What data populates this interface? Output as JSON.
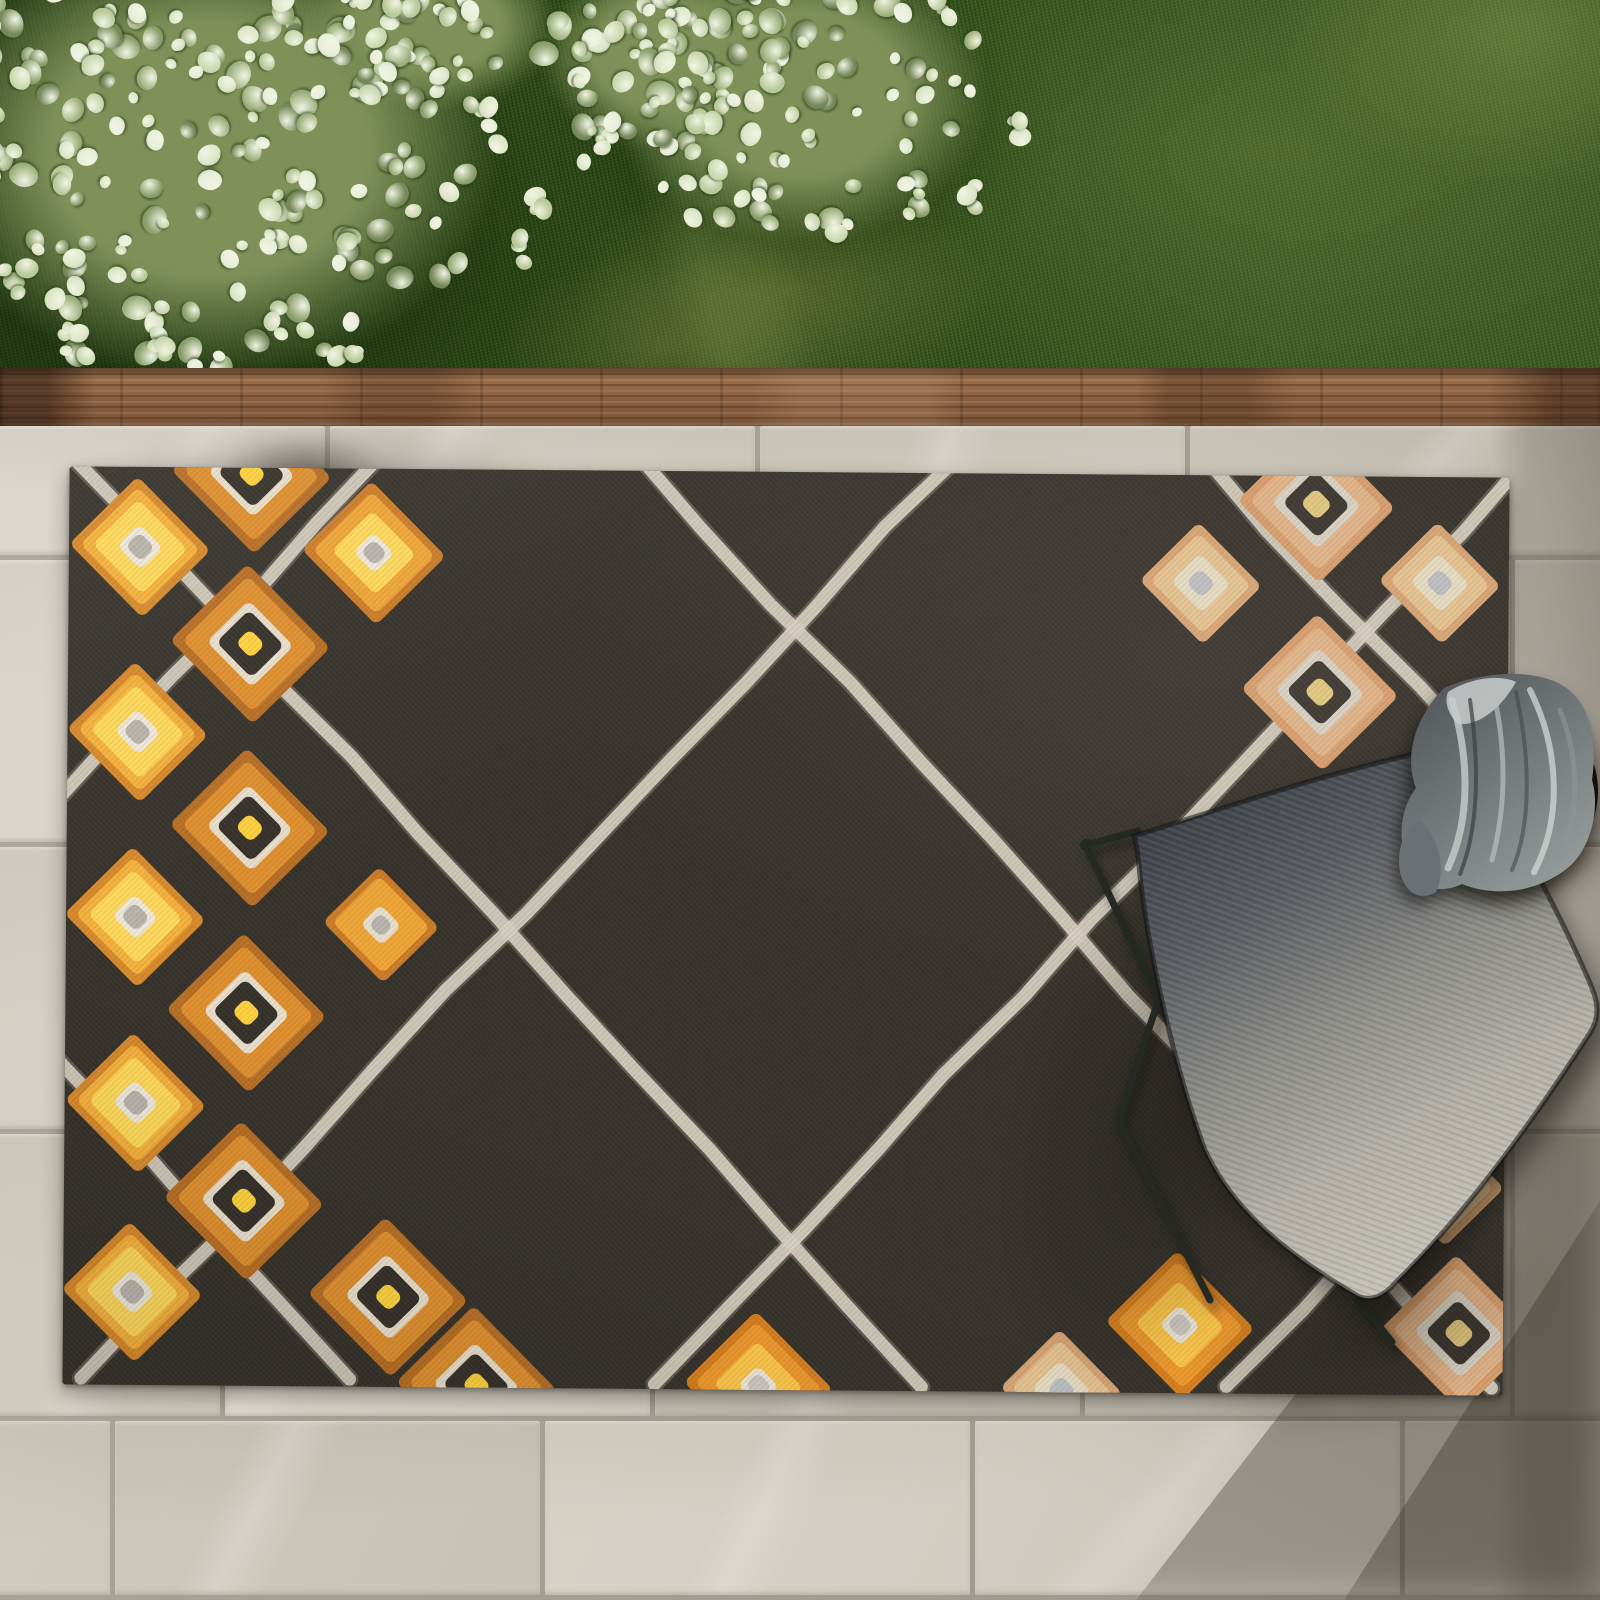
{
  "meta": {
    "description": "Top-down outdoor scene: charcoal Moroccan-trellis area rug with cream lattice and orange diamond motifs on a stone tile patio; grass lawn and variegated shrub above a wood edging board; gray ombre sling chair, round wicker side table with gray towel; soft shadows lower right"
  },
  "scene": {
    "canvas": {
      "width": 1600,
      "height": 1600
    },
    "grass": {
      "base": "#33501d"
    },
    "bush": {
      "light": [
        "#e9eedb",
        "#dde6c8",
        "#ccd9b1",
        "#b9c99b"
      ],
      "dark": [
        "#a2b483",
        "#8da06f",
        "#76885b"
      ],
      "clumps": [
        [
          210,
          150,
          290,
          230,
          205
        ],
        [
          660,
          55,
          120,
          95,
          62
        ],
        [
          800,
          95,
          190,
          150,
          92
        ],
        [
          430,
          25,
          130,
          85,
          46
        ]
      ],
      "strays": [
        [
          545,
          205
        ],
        [
          520,
          250
        ],
        [
          80,
          345
        ],
        [
          150,
          360
        ],
        [
          960,
          200
        ],
        [
          1005,
          135
        ],
        [
          350,
          365
        ],
        [
          600,
          150
        ]
      ]
    },
    "wood_edge": {
      "color": "#8a5f41"
    },
    "patio": {
      "tile_w": 430,
      "gap": 5,
      "grout": "#a7a196",
      "palette": [
        "#d8d3c8",
        "#d3cec3",
        "#cdc8bc",
        "#dcd7cc",
        "#d0cabe",
        "#d6d0c5"
      ],
      "rows": [
        [
          426,
          134,
          -100
        ],
        [
          560,
          287,
          -205
        ],
        [
          847,
          287,
          -100
        ],
        [
          1134,
          287,
          -205
        ],
        [
          1421,
          179,
          -315
        ]
      ]
    },
    "rug": {
      "x": 66,
      "y": 472,
      "w": 1440,
      "h": 918,
      "rot": 0.45,
      "bg": "#36322b",
      "line": {
        "color": "#d7d0c1",
        "width": 13,
        "slope": 1.08,
        "wobble": 11,
        "a_starts": [
          -557,
          13,
          583,
          1153,
          1723
        ],
        "b_starts": [
          298,
          868,
          1438,
          2008
        ]
      },
      "motif_types": {
        "yellow": [
          [
            "#d98a2b",
            104
          ],
          [
            "#f6b23c",
            88
          ],
          [
            "#ffd95c",
            70
          ],
          [
            "#efe8da",
            34
          ],
          [
            "#b9b4ac",
            22
          ]
        ],
        "orangeRing": [
          [
            "#b96f24",
            118
          ],
          [
            "#e0902e",
            100
          ],
          [
            "#e9dfcc",
            64
          ],
          [
            "#35312a",
            50
          ],
          [
            "#ffd23e",
            22
          ]
        ],
        "orangeYellowGray": [
          [
            "#cd7d28",
            106
          ],
          [
            "#f0a636",
            90
          ],
          [
            "#ffd95c",
            62
          ],
          [
            "#efe8da",
            30
          ],
          [
            "#b9b4ac",
            20
          ]
        ],
        "orangeSmallGray": [
          [
            "#cd7d28",
            86
          ],
          [
            "#f0a636",
            72
          ],
          [
            "#e8dfce",
            30
          ],
          [
            "#b9b4ac",
            18
          ]
        ],
        "peachRing": [
          [
            "#d99e6c",
            116
          ],
          [
            "#e2b488",
            98
          ],
          [
            "#d9d2c4",
            66
          ],
          [
            "#3a352e",
            50
          ],
          [
            "#e2c87e",
            24
          ]
        ],
        "peachSmall": [
          [
            "#d9a573",
            90
          ],
          [
            "#e6c391",
            74
          ],
          [
            "#e6dcc2",
            44
          ],
          [
            "#bcbfc2",
            22
          ]
        ],
        "orangeBright": [
          [
            "#d9811f",
            110
          ],
          [
            "#f09a2e",
            94
          ],
          [
            "#ffc84a",
            66
          ],
          [
            "#efe8da",
            30
          ],
          [
            "#cfcac2",
            20
          ]
        ]
      },
      "motifs": [
        [
          137,
          552,
          "yellow"
        ],
        [
          248,
          478,
          "orangeRing"
        ],
        [
          371,
          556,
          "orangeYellowGray"
        ],
        [
          248,
          648,
          "orangeRing"
        ],
        [
          136,
          737,
          "yellow"
        ],
        [
          249,
          832,
          "orangeRing"
        ],
        [
          135,
          922,
          "yellow"
        ],
        [
          381,
          928,
          "orangeSmallGray"
        ],
        [
          247,
          1017,
          "orangeRing"
        ],
        [
          137,
          1108,
          "yellow"
        ],
        [
          246,
          1205,
          "orangeRing"
        ],
        [
          135,
          1297,
          "yellow"
        ],
        [
          391,
          1300,
          "orangeRing"
        ],
        [
          480,
          1388,
          "orangeRing"
        ],
        [
          762,
          1386,
          "orangeBright"
        ],
        [
          1313,
          500,
          "peachRing"
        ],
        [
          1198,
          580,
          "peachSmall"
        ],
        [
          1437,
          578,
          "peachSmall"
        ],
        [
          1318,
          688,
          "peachRing"
        ],
        [
          1445,
          1180,
          "peachSmall"
        ],
        [
          1462,
          1328,
          "peachRing"
        ],
        [
          1183,
          1322,
          "orangeBright"
        ],
        [
          1065,
          1388,
          "peachSmall"
        ]
      ]
    },
    "chair": {
      "frame_color": "#242a23",
      "fabric_gradient": [
        "#3d4146",
        "#5a5e62",
        "#8c8c88",
        "#b3b0a7",
        "#c6c3b9"
      ],
      "gradient_line": [
        1150,
        820,
        1430,
        1270
      ],
      "frame_lines": [
        [
          1086,
          845,
          1138,
          831
        ],
        [
          1088,
          850,
          1152,
          985
        ],
        [
          1152,
          985,
          1235,
          1040
        ],
        [
          1196,
          890,
          1118,
          1120
        ],
        [
          1118,
          1120,
          1210,
          1300
        ],
        [
          1358,
          1300,
          1392,
          1342
        ]
      ],
      "fabric_path": "M1134,836 C1230,806 1330,772 1424,752 C1448,746 1462,752 1472,766 C1520,834 1572,940 1592,988 C1600,1008 1598,1022 1588,1036 C1540,1110 1470,1210 1396,1282 C1384,1296 1372,1302 1358,1296 C1296,1260 1235,1215 1205,1150 C1175,1070 1148,950 1140,876 C1138,854 1136,842 1134,836 Z"
    },
    "table": {
      "cx": 1508,
      "cy": 791,
      "r": 90
    },
    "towel": {
      "grad": [
        "#565b5e",
        "#9aa09f"
      ],
      "grad_line": [
        1440,
        690,
        1590,
        880
      ],
      "base": "M1444,688 C1480,672 1530,668 1560,684 C1590,700 1598,740 1592,780 C1600,806 1592,846 1570,866 C1540,892 1496,898 1462,884 C1436,896 1414,886 1408,862 C1396,836 1402,806 1416,788 C1404,758 1414,718 1444,688 Z",
      "tail": "M1420,820 C1440,840 1446,868 1436,892 C1420,902 1404,892 1400,872 C1396,848 1404,830 1420,820 Z",
      "highlight_blob": "M1448,692 C1470,678 1500,674 1516,682 C1500,710 1478,726 1458,724 C1448,714 1444,702 1448,692 Z",
      "folds": [
        [
          "M1452,700 C1470,760 1470,820 1448,868",
          "#c9cdcb",
          7,
          0.8
        ],
        [
          "M1492,686 C1505,740 1508,800 1492,860",
          "#b9bec0",
          5,
          0.7
        ],
        [
          "M1530,690 C1560,750 1562,820 1534,872",
          "#d3d7d5",
          6,
          0.75
        ],
        [
          "M1560,710 C1580,760 1580,820 1558,860",
          "#8f9596",
          5,
          0.6
        ],
        [
          "M1470,700 C1480,770 1478,830 1460,874",
          "#3a3f42",
          4,
          0.7
        ],
        [
          "M1516,692 C1530,756 1532,824 1512,870",
          "#45494c",
          4,
          0.6
        ]
      ]
    }
  }
}
